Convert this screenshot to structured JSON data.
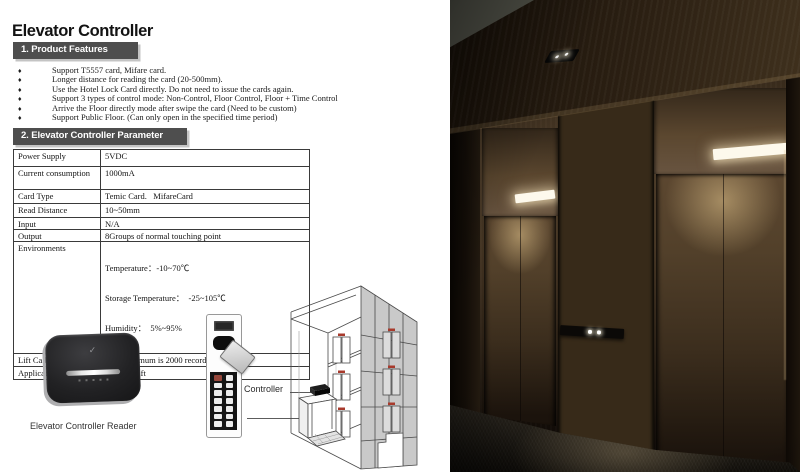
{
  "icons": {
    "bullet_glyph": "♦",
    "reader_logo_glyph": "✓"
  },
  "colors": {
    "heading_bg": "#4e4e4e",
    "heading_text": "#ffffff",
    "table_border": "#3a3a3a",
    "photo_bronze_door": "#5c4730",
    "photo_dark_wood": "#32261a",
    "photo_light_bar": "#fdf9ec",
    "photo_carpet": "#201b13"
  },
  "document": {
    "title": "Elevator Controller",
    "features": {
      "heading": "1. Product Features",
      "items": [
        "Support T5557 card, Mifare card.",
        "Longer distance for reading the card (20-500mm).",
        "Use the Hotel Lock Card directly. Do not need to issue the cards again.",
        "Support 3 types of control mode: Non-Control, Floor Control, Floor + Time Control",
        "Arrive the Floor directly mode after swipe the card (Need to be custom)",
        "Support Public Floor. (Can only open in the specified time period)"
      ]
    },
    "parameters": {
      "heading": "2. Elevator Controller Parameter",
      "rows": [
        {
          "label": "Power Supply",
          "value": "5VDC"
        },
        {
          "label": "Current consumption",
          "value": "1000mA"
        },
        {
          "label": "Card Type",
          "value": "Temic Card.   MifareCard"
        },
        {
          "label": "Read Distance",
          "value": "10~50mm"
        },
        {
          "label": "Input",
          "value": "N/A"
        },
        {
          "label": "Output",
          "value": "8Groups of normal touching point"
        },
        {
          "label": "Environments",
          "lines": [
            "Temperature：-10~70℃",
            "Storage Temperature：  -25~105℃",
            "Humidity：  5%~95%"
          ]
        },
        {
          "label": "Lift Calling records",
          "value": "The Maximum is 2000 records"
        },
        {
          "label": "Applications",
          "value": "Various Lift"
        }
      ]
    },
    "figures": {
      "reader_caption": "Elevator Controller Reader",
      "controller_label": "Controller"
    }
  }
}
